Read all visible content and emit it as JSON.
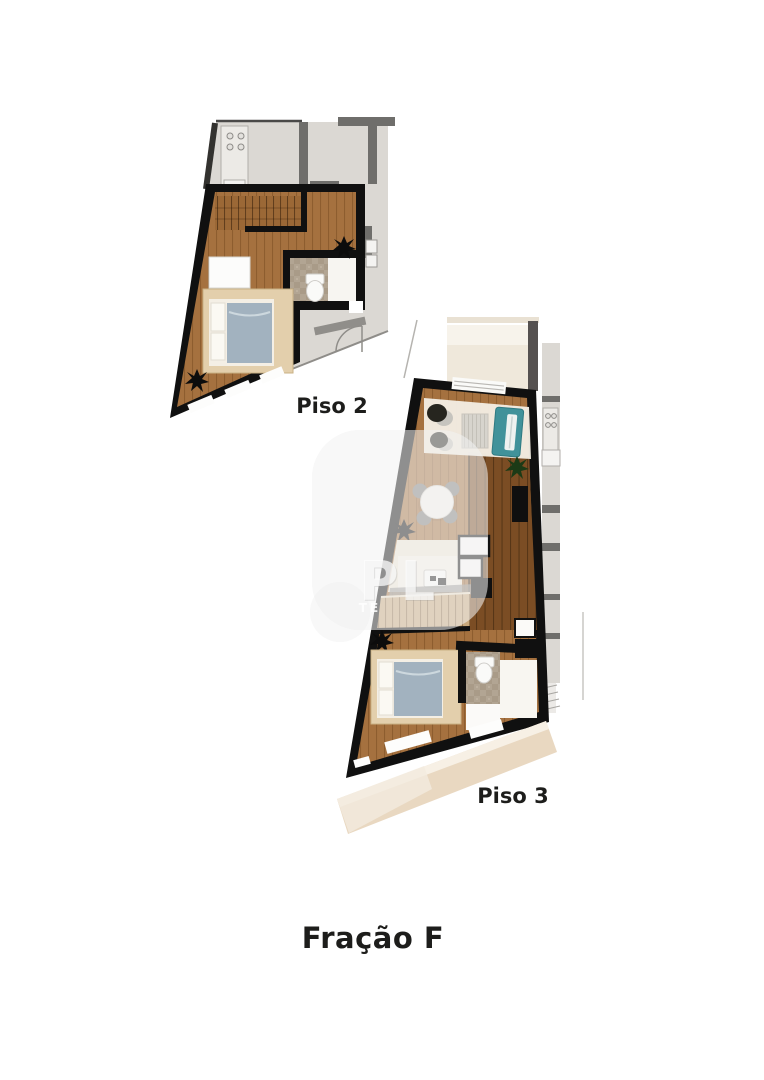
{
  "document": {
    "title": "Fração F",
    "background": "#ffffff"
  },
  "floor_plans": [
    {
      "label": "Piso 2"
    },
    {
      "label": "Piso 3"
    }
  ],
  "watermark": {
    "text_top": "PL",
    "text_bottom": "TE"
  },
  "colors": {
    "wall": "#101010",
    "context": "#dbd8d3",
    "context_wall": "#6f6e6b",
    "wood": "#a5713f",
    "wood_dark": "#7b4d24",
    "wood_plank_line": "#7a4c22",
    "stairs_wood": "#9b6836",
    "stairs_light": "#c8a87c",
    "bed_platform": "#e3cfac",
    "mattress": "#a2b2bf",
    "linen": "#f4efe5",
    "stone": "#b2a593",
    "teal_sofa": "#41929a",
    "rug": "#f2ede3",
    "terrace": "#e9d8c1",
    "kitchen_counter": "#efe8da",
    "label_text": "#1d1d1b"
  }
}
